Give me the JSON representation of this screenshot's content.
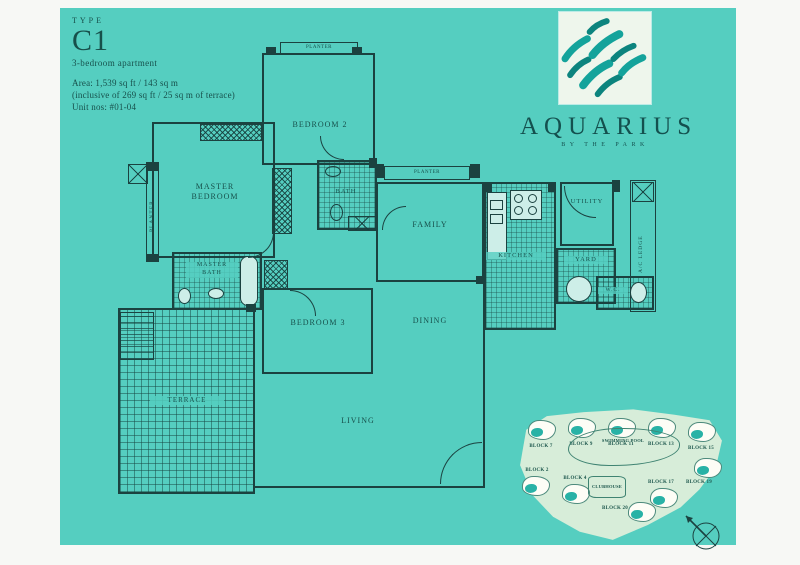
{
  "page": {
    "background": "#55cec0",
    "line_color": "#1b4240",
    "text_color": "#17504b"
  },
  "info": {
    "type_label": "TYPE",
    "type_code": "C1",
    "subtitle": "3-bedroom apartment",
    "area": "Area: 1,539 sq ft / 143 sq m",
    "area_note": "(inclusive of 269 sq ft / 25 sq m of terrace)",
    "units": "Unit nos: #01-04"
  },
  "logo": {
    "name": "AQUARIUS",
    "tagline": "BY THE PARK",
    "accent_color": "#14a39b",
    "icon": "brush-stroke-waves-icon"
  },
  "rooms": {
    "master_bedroom": "MASTER\nBEDROOM",
    "bedroom2": "BEDROOM 2",
    "bedroom3": "BEDROOM 3",
    "bath": "BATH",
    "master_bath": "MASTER\nBATH",
    "family": "FAMILY",
    "dining": "DINING",
    "living": "LIVING",
    "kitchen": "KITCHEN",
    "utility": "UTILITY",
    "yard": "YARD",
    "wc": "W.C.",
    "terrace": "TERRACE",
    "ac_ledge": "A/C LEDGE",
    "planter_left": "PLANTER",
    "planter_bedroom2": "PLANTER",
    "planter_family": "PLANTER"
  },
  "site_plan": {
    "blocks": [
      "BLOCK 7",
      "BLOCK 9",
      "BLOCK 11",
      "BLOCK 13",
      "BLOCK 15",
      "BLOCK 2",
      "BLOCK 4",
      "BLOCK 17",
      "BLOCK 19",
      "BLOCK 20"
    ],
    "swimming_pool": "SWIMMING POOL",
    "clubhouse": "CLUBHOUSE",
    "icons": {
      "compass": "compass-rose-north-arrow"
    }
  }
}
